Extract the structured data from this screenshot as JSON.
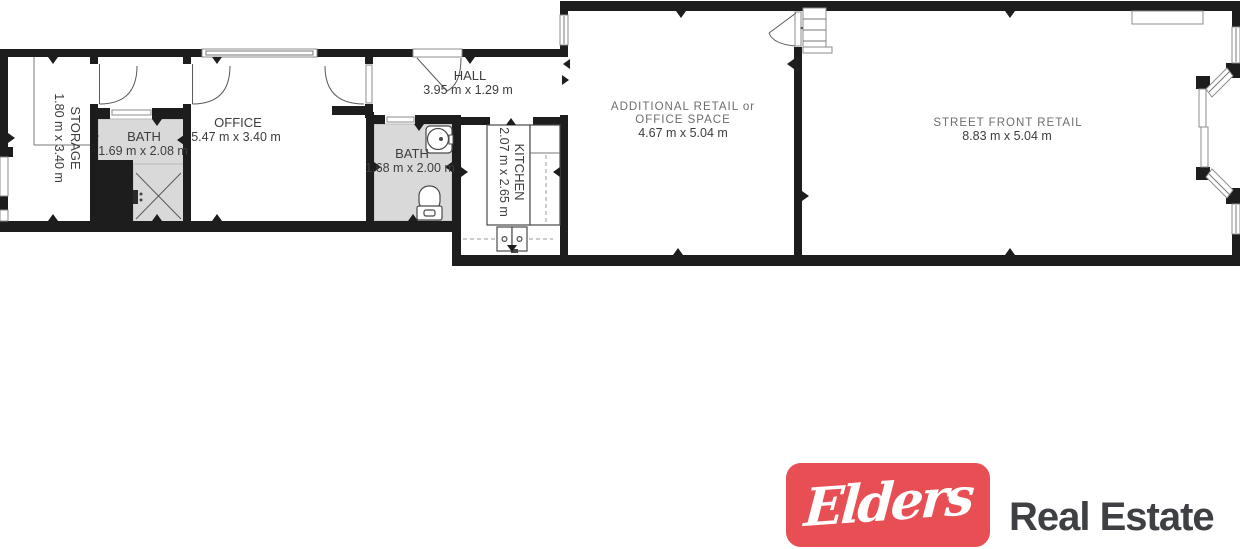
{
  "plan": {
    "rooms": {
      "storage": {
        "name": "STORAGE",
        "dims": "1.80 m x 3.40 m"
      },
      "bath1": {
        "name": "BATH",
        "dims": "1.69 m x 2.08 m"
      },
      "office": {
        "name": "OFFICE",
        "dims": "5.47 m x 3.40 m"
      },
      "hall": {
        "name": "HALL",
        "dims": "3.95 m x 1.29 m"
      },
      "bath2": {
        "name": "BATH",
        "dims": "1.68 m x 2.00 m"
      },
      "kitchen": {
        "name": "KITCHEN",
        "dims": "2.07 m x 2.65 m"
      },
      "additional_retail": {
        "name_line1": "ADDITIONAL RETAIL or",
        "name_line2": "OFFICE SPACE",
        "dims": "4.67 m x 5.04 m"
      },
      "street_front_retail": {
        "name": "STREET FRONT RETAIL",
        "dims": "8.83 m x 5.04 m"
      }
    },
    "colors": {
      "wall": "#1d1d1d",
      "tile": "#d9d9d9",
      "label": "#3d3d3d",
      "retail_label": "#6e6e6e",
      "line": "#5a5a5a"
    }
  },
  "logo": {
    "brand": "Elders",
    "suffix": "Real Estate",
    "red": "#e74f55",
    "text_color": "#3e4043"
  }
}
